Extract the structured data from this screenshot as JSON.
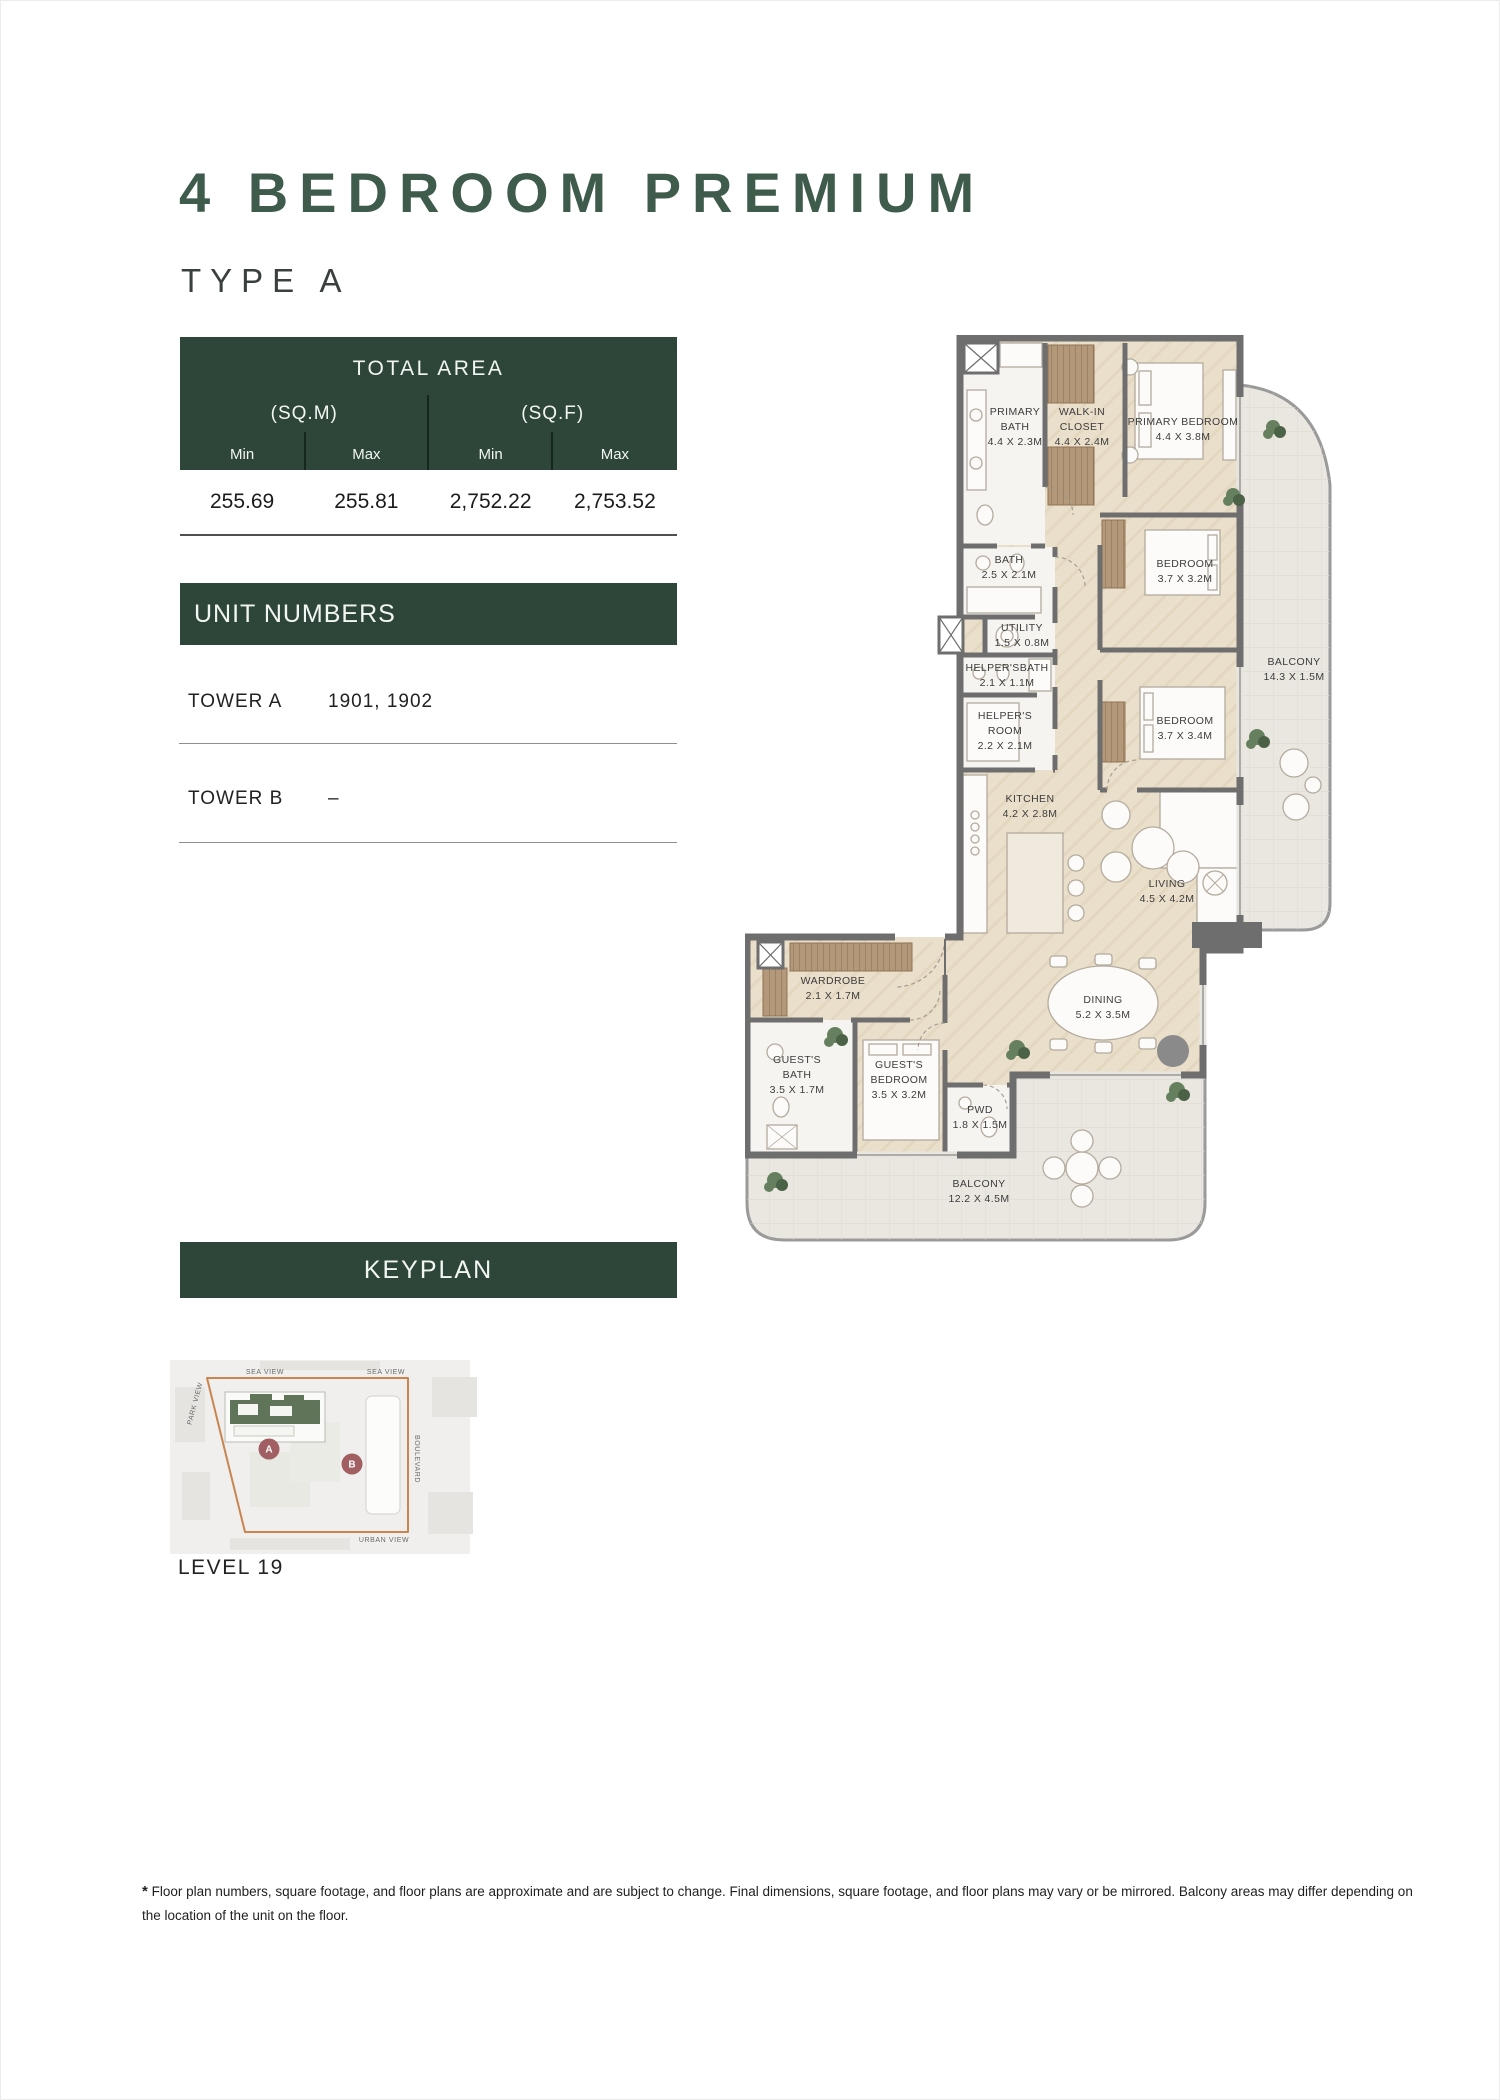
{
  "page": {
    "title": "4 BEDROOM PREMIUM",
    "subtitle": "TYPE A"
  },
  "total_area": {
    "header": "TOTAL AREA",
    "unit_groups": [
      {
        "label": "(SQ.M)"
      },
      {
        "label": "(SQ.F)"
      }
    ],
    "columns": [
      "Min",
      "Max",
      "Min",
      "Max"
    ],
    "values": [
      "255.69",
      "255.81",
      "2,752.22",
      "2,753.52"
    ]
  },
  "unit_numbers": {
    "header": "UNIT NUMBERS",
    "rows": [
      {
        "label": "TOWER A",
        "value": "1901, 1902"
      },
      {
        "label": "TOWER B",
        "value": "–"
      }
    ]
  },
  "floorplan": {
    "rooms": [
      {
        "lines": [
          "PRIMARY",
          "BATH",
          "4.4 X 2.3M"
        ],
        "x": 270,
        "y": 80
      },
      {
        "lines": [
          "WALK-IN",
          "CLOSET",
          "4.4 X 2.4M"
        ],
        "x": 337,
        "y": 80
      },
      {
        "lines": [
          "PRIMARY BEDROOM",
          "4.4 X 3.8M"
        ],
        "x": 438,
        "y": 90
      },
      {
        "lines": [
          "BATH",
          "2.5 X 2.1M"
        ],
        "x": 264,
        "y": 228
      },
      {
        "lines": [
          "BEDROOM",
          "3.7 X 3.2M"
        ],
        "x": 440,
        "y": 232
      },
      {
        "lines": [
          "UTILITY",
          "1.5 X 0.8M"
        ],
        "x": 277,
        "y": 296
      },
      {
        "lines": [
          "HELPER'SBATH",
          "2.1 X 1.1M"
        ],
        "x": 262,
        "y": 336
      },
      {
        "lines": [
          "HELPER'S",
          "ROOM",
          "2.2 X 2.1M"
        ],
        "x": 260,
        "y": 384
      },
      {
        "lines": [
          "BEDROOM",
          "3.7 X 3.4M"
        ],
        "x": 440,
        "y": 389
      },
      {
        "lines": [
          "BALCONY",
          "14.3 X 1.5M"
        ],
        "x": 549,
        "y": 330
      },
      {
        "lines": [
          "KITCHEN",
          "4.2 X 2.8M"
        ],
        "x": 285,
        "y": 467
      },
      {
        "lines": [
          "LIVING",
          "4.5 X 4.2M"
        ],
        "x": 422,
        "y": 552
      },
      {
        "lines": [
          "WARDROBE",
          "2.1 X 1.7M"
        ],
        "x": 88,
        "y": 649
      },
      {
        "lines": [
          "GUEST'S",
          "BATH",
          "3.5 X 1.7M"
        ],
        "x": 52,
        "y": 728
      },
      {
        "lines": [
          "GUEST'S",
          "BEDROOM",
          "3.5 X 3.2M"
        ],
        "x": 154,
        "y": 733
      },
      {
        "lines": [
          "PWD",
          "1.8 X 1.5M"
        ],
        "x": 235,
        "y": 778
      },
      {
        "lines": [
          "DINING",
          "5.2 X 3.5M"
        ],
        "x": 358,
        "y": 668
      },
      {
        "lines": [
          "BALCONY",
          "12.2 X 4.5M"
        ],
        "x": 234,
        "y": 852
      }
    ]
  },
  "keyplan": {
    "header": "KEYPLAN",
    "level": "LEVEL 19",
    "badges": [
      {
        "label": "A",
        "x": 99,
        "y": 97
      },
      {
        "label": "B",
        "x": 182,
        "y": 112
      }
    ],
    "labels": [
      {
        "text": "SEA VIEW",
        "x": 95,
        "y": 22,
        "rotate": 0
      },
      {
        "text": "SEA VIEW",
        "x": 216,
        "y": 22,
        "rotate": 0
      },
      {
        "text": "PARK VIEW",
        "x": 27,
        "y": 52,
        "rotate": -75
      },
      {
        "text": "BOULEVARD",
        "x": 245,
        "y": 107,
        "rotate": 90
      },
      {
        "text": "URBAN VIEW",
        "x": 214,
        "y": 190,
        "rotate": 0
      }
    ]
  },
  "footnote": {
    "marker": "*",
    "text": " Floor plan numbers, square footage, and floor plans are approximate and are subject to change. Final dimensions, square footage, and floor plans may vary or be mirrored. Balcony areas may differ depending on the location of the unit on the floor."
  },
  "colors": {
    "accent_green": "#2E463A",
    "title_green": "#3E5B4B",
    "wall_gray": "#6E6E6E",
    "wood_floor": "#EADFCB",
    "balcony_floor": "#EAE7E1",
    "keyplan_orange": "#C9854F",
    "badge_maroon": "#A25F63"
  }
}
